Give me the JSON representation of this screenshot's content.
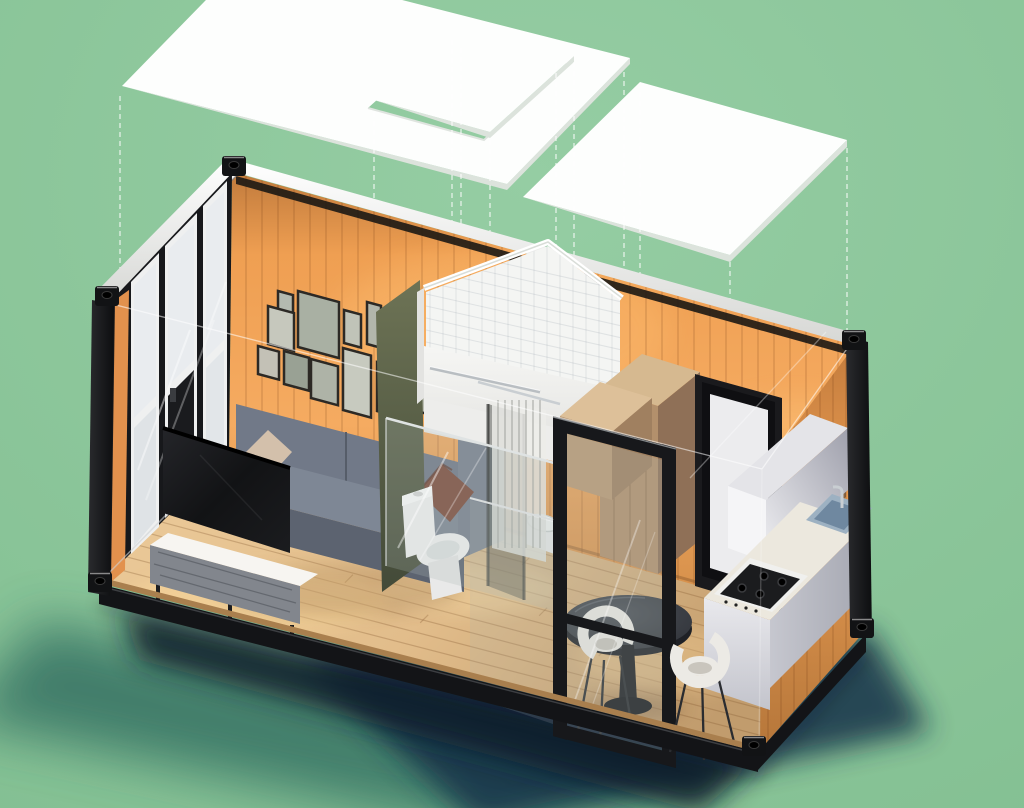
{
  "scene": {
    "title": "Isometric exploded-view 3D render of a shipping-container tiny home with roof panels lifted above",
    "background": "#8cc79b",
    "palette": {
      "bg_green": "#8cc79b",
      "roof_white": "#fdfefd",
      "roof_edge": "#dce3dc",
      "rail_white": "#f3f4f2",
      "frame_black": "#131417",
      "post_dark": "#1b1c1f",
      "rail_shadow": "#1c1814",
      "wall_orange": "#eda053",
      "wall_orange_dark": "#c9803d",
      "floor_edge_wood": "#a97f4e",
      "window_glass": "#e9ecef",
      "window_frame_dark": "#17181b",
      "window_frame_white": "#eff0f0",
      "orange_return": "#e2914d",
      "tv_black": "#141517",
      "sofa_gray": "#717988",
      "sofa_gray_light": "#7e8795",
      "sofa_gray_dark": "#656c79",
      "sofa_skirt": "#5c6370",
      "pillow_brown": "#7c4a3a",
      "pillow_beige": "#d3c0ab",
      "console_top": "#f7f5f1",
      "console_front": "#82868d",
      "console_leg": "#1c1d20",
      "photo_frame": "#2c2925",
      "olive_glass": "#59604a",
      "tile_white": "#f4f5f3",
      "tile_line": "rgba(120,130,140,0.16)",
      "shower_front": "#f1f1ef",
      "shower_band": "#ededeb",
      "curtain": "rgba(236,236,233,0.85)",
      "curtain_fold": "rgba(160,162,158,0.5)",
      "dark_glass": "rgba(62,64,60,0.45)",
      "chrome": "#c9ced2",
      "toilet_white": "#f5f5f5",
      "wood_top": "#d6b990",
      "wood_front": "#b3906c",
      "wood_side": "#8f7057",
      "wood_top2": "#ddc099",
      "wood_front2": "#bb9a74",
      "wood_side2": "#a08060",
      "door_black": "#1a1a1d",
      "door_inner": "#0f0f12",
      "door_panel": "#ececee",
      "cabinet_bright": "#f5f5f7",
      "cabinet_top": "#e4e4e8",
      "stove_tray": "#f0f0ee",
      "stove_black": "#1b1c1e",
      "sink_steel": "#9db1c2",
      "sink_deep": "#6f88a0",
      "reflection_blue": "#7fa3c2",
      "table_side": "#1f2126",
      "table_stem": "#1c1e22",
      "chair_white": "#eceae5",
      "chair_shadow": "#c9c5bd",
      "chair_leg": "#2a2c30",
      "glass_tint": "rgba(173,185,180,0.25)",
      "slat_line": "rgba(98,52,14,0.18)",
      "plank_line": "rgba(128,85,45,0.3)",
      "dash_line": "rgba(255,255,255,0.75)",
      "edge_line": "rgba(255,255,255,0.55)"
    },
    "objects": [
      "roof-panel-main",
      "roof-panel-middle",
      "roof-panel-right",
      "projection-lines",
      "window-wall",
      "gallery-wall",
      "sofa",
      "tv",
      "media-console",
      "bathroom-pod",
      "shower-enclosure",
      "shower-curtain",
      "toilet",
      "bathroom-sink",
      "wardrobe",
      "interior-door",
      "kitchen-upper-cabinet",
      "kitchen-counter",
      "gas-stove",
      "kitchen-sink",
      "dining-table",
      "dining-chairs",
      "entry-glass-door",
      "corner-castings",
      "ground-shadow"
    ]
  },
  "gallery_frames": [
    {
      "x": 278,
      "y": 291,
      "w": 15,
      "h": 20,
      "tone": "#b4bab0"
    },
    {
      "x": 268,
      "y": 306,
      "w": 26,
      "h": 38,
      "tone": "#c6c8bd"
    },
    {
      "x": 298,
      "y": 291,
      "w": 41,
      "h": 56,
      "tone": "#a9b0a3"
    },
    {
      "x": 344,
      "y": 310,
      "w": 17,
      "h": 33,
      "tone": "#c0c3b8"
    },
    {
      "x": 367,
      "y": 302,
      "w": 14,
      "h": 42,
      "tone": "#b2b6ab"
    },
    {
      "x": 258,
      "y": 346,
      "w": 21,
      "h": 28,
      "tone": "#c3c1b6"
    },
    {
      "x": 284,
      "y": 351,
      "w": 25,
      "h": 33,
      "tone": "#99a194"
    },
    {
      "x": 311,
      "y": 359,
      "w": 27,
      "h": 39,
      "tone": "#aeb3a7"
    },
    {
      "x": 343,
      "y": 348,
      "w": 28,
      "h": 62,
      "tone": "#c7cabf"
    },
    {
      "x": 377,
      "y": 362,
      "w": 27,
      "h": 49,
      "tone": "#a5ab9e"
    },
    {
      "x": 409,
      "y": 373,
      "w": 20,
      "h": 36,
      "tone": "#bcbfb3"
    }
  ],
  "frame_slope": 0.27,
  "dashed_lines": [
    {
      "x": 120,
      "y1": 96,
      "y2": 292
    },
    {
      "x": 374,
      "y1": 112,
      "y2": 208
    },
    {
      "x": 452,
      "y1": 40,
      "y2": 229
    },
    {
      "x": 461,
      "y1": 48,
      "y2": 232
    },
    {
      "x": 490,
      "y1": 140,
      "y2": 240
    },
    {
      "x": 556,
      "y1": 64,
      "y2": 258
    },
    {
      "x": 574,
      "y1": 62,
      "y2": 263
    },
    {
      "x": 624,
      "y1": 72,
      "y2": 277
    },
    {
      "x": 640,
      "y1": 92,
      "y2": 281
    },
    {
      "x": 730,
      "y1": 262,
      "y2": 468
    },
    {
      "x": 847,
      "y1": 148,
      "y2": 330
    }
  ],
  "wall_slats": {
    "back": {
      "x0": 246,
      "x1": 852,
      "step": 16,
      "y0": 150,
      "y1": 650
    },
    "right": {
      "x0": 768,
      "x1": 860,
      "step": 13,
      "y0": 330,
      "y1": 760
    }
  },
  "floor": {
    "corners": {
      "BL": [
        230,
        452
      ],
      "FL": [
        103,
        580
      ],
      "BR": [
        860,
        628
      ],
      "FR": [
        758,
        748
      ]
    },
    "plank_count": 10,
    "ticks": [
      [
        0.12,
        0.3
      ],
      [
        0.3,
        0.62
      ],
      [
        0.22,
        0.85
      ],
      [
        0.5,
        0.2
      ],
      [
        0.58,
        0.5
      ],
      [
        0.44,
        0.75
      ],
      [
        0.78,
        0.35
      ],
      [
        0.7,
        0.66
      ],
      [
        0.88,
        0.5
      ],
      [
        0.34,
        0.15
      ]
    ]
  },
  "tiles": {
    "x0": 430,
    "x1": 618,
    "v_step": 13,
    "yTop": 238,
    "yBot": 396,
    "h_y0": 246,
    "h_y1": 392,
    "h_step": 12,
    "h_drop": 44
  },
  "curtain_folds": {
    "x0": 498,
    "x1": 544,
    "step": 7,
    "y0": 400,
    "y1": 548
  }
}
